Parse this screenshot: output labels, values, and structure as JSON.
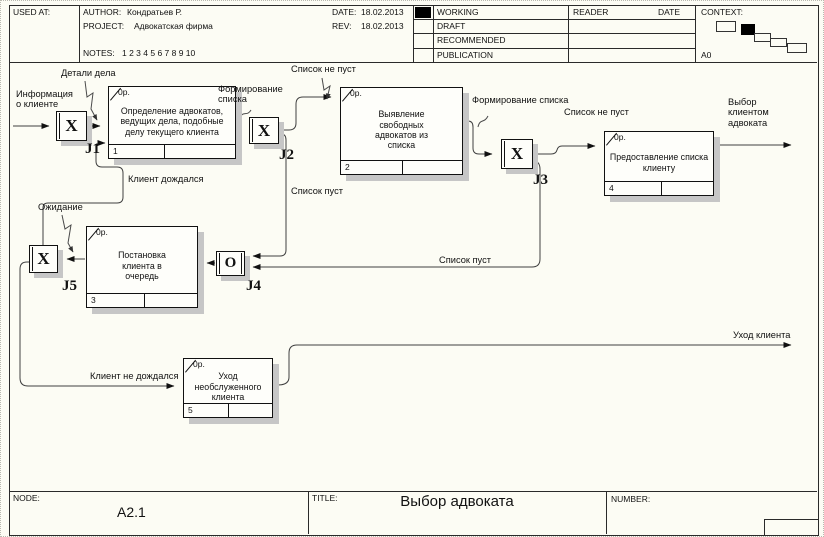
{
  "header": {
    "used_at_label": "USED AT:",
    "author_label": "AUTHOR:",
    "author": "Кондратьев Р.",
    "project_label": "PROJECT:",
    "project": "Адвокатская фирма",
    "notes_label": "NOTES:",
    "notes": "1 2 3 4 5 6 7 8 9 10",
    "date_label": "DATE:",
    "date": "18.02.2013",
    "rev_label": "REV:",
    "rev": "18.02.2013",
    "statuses": [
      "WORKING",
      "DRAFT",
      "RECOMMENDED",
      "PUBLICATION"
    ],
    "reader_label": "READER",
    "reader_date_label": "DATE",
    "context_label": "CONTEXT:",
    "context_node": "A0"
  },
  "footer": {
    "node_label": "NODE:",
    "node": "A2.1",
    "title_label": "TITLE:",
    "title": "Выбор адвоката",
    "number_label": "NUMBER:"
  },
  "boxes": [
    {
      "num": "1",
      "cost": "0р.",
      "text": "Определение адвокатов, ведущих дела, подобные делу текущего клиента"
    },
    {
      "num": "2",
      "cost": "0р.",
      "text": "Выявление свободных адвокатов из списка"
    },
    {
      "num": "3",
      "cost": "0р.",
      "text": "Постановка клиента в очередь"
    },
    {
      "num": "4",
      "cost": "0р.",
      "text": "Предоставление списка клиенту"
    },
    {
      "num": "5",
      "cost": "0р.",
      "text": "Уход необслуженного клиента"
    }
  ],
  "junctions": [
    {
      "id": "J1",
      "letter": "X",
      "type": "XOR"
    },
    {
      "id": "J2",
      "letter": "X",
      "type": "XOR"
    },
    {
      "id": "J3",
      "letter": "X",
      "type": "XOR"
    },
    {
      "id": "J4",
      "letter": "O",
      "type": "OR"
    },
    {
      "id": "J5",
      "letter": "X",
      "type": "XOR"
    }
  ],
  "labels": {
    "client_info": "Информация\nо клиенте",
    "case_details": "Детали дела",
    "list_forming_1": "Формирование\nсписка",
    "list_not_empty_1": "Список не пуст",
    "list_forming_2": "Формирование списка",
    "list_not_empty_2": "Список не пуст",
    "client_choice": "Выбор\nклиентом\nадвоката",
    "client_waited": "Клиент дождался",
    "waiting": "Ожидание",
    "list_empty_1": "Список пуст",
    "list_empty_2": "Список пуст",
    "client_not_waited": "Клиент не дождался",
    "client_leave": "Уход клиента"
  },
  "colors": {
    "paper": "#fcfcf4",
    "line": "#3f3f3f",
    "shadow": "#c6c6c6",
    "status_mark": "#000000"
  }
}
